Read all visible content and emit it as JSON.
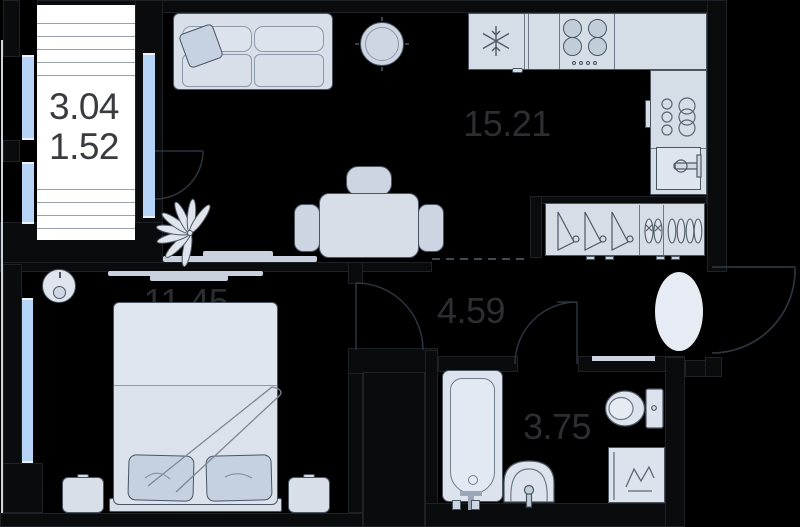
{
  "title": "Apartment floor plan (1-room)",
  "rooms": {
    "balcony": {
      "name": "balcony",
      "area_full": "3.04",
      "area_reduced": "1.52"
    },
    "living_kitchen": {
      "name": "living-kitchen",
      "area": "15.21"
    },
    "bedroom": {
      "name": "bedroom",
      "area": "11.45"
    },
    "hallway": {
      "name": "hallway",
      "area": "4.59"
    },
    "bathroom": {
      "name": "bathroom",
      "area": "3.75"
    }
  },
  "colors": {
    "background": "#000000",
    "wall": "#0a0b0d",
    "furniture_fill": "#d7dee8",
    "furniture_outline": "#4a5562",
    "window_glass": "#b6d5f6",
    "balcony_floor": "#ffffff",
    "label_text": "#2d2e31",
    "rug": "#e7ebf3"
  },
  "fixtures": [
    "sofa-icon",
    "pillow-icon",
    "round-table-icon",
    "dining-table-icon",
    "chair-icon",
    "plant-icon",
    "tv-console-icon",
    "fridge-snowflake-icon",
    "hob-burners-icon",
    "kitchen-sink-icon",
    "dish-stack-icon",
    "hanger-icon",
    "shoes-icon",
    "bed-icon",
    "nightstand-icon",
    "robot-vacuum-icon",
    "rug-icon",
    "bathtub-icon",
    "washbasin-icon",
    "toilet-icon",
    "washing-machine-icon",
    "door-swing-icon",
    "window-icon"
  ]
}
